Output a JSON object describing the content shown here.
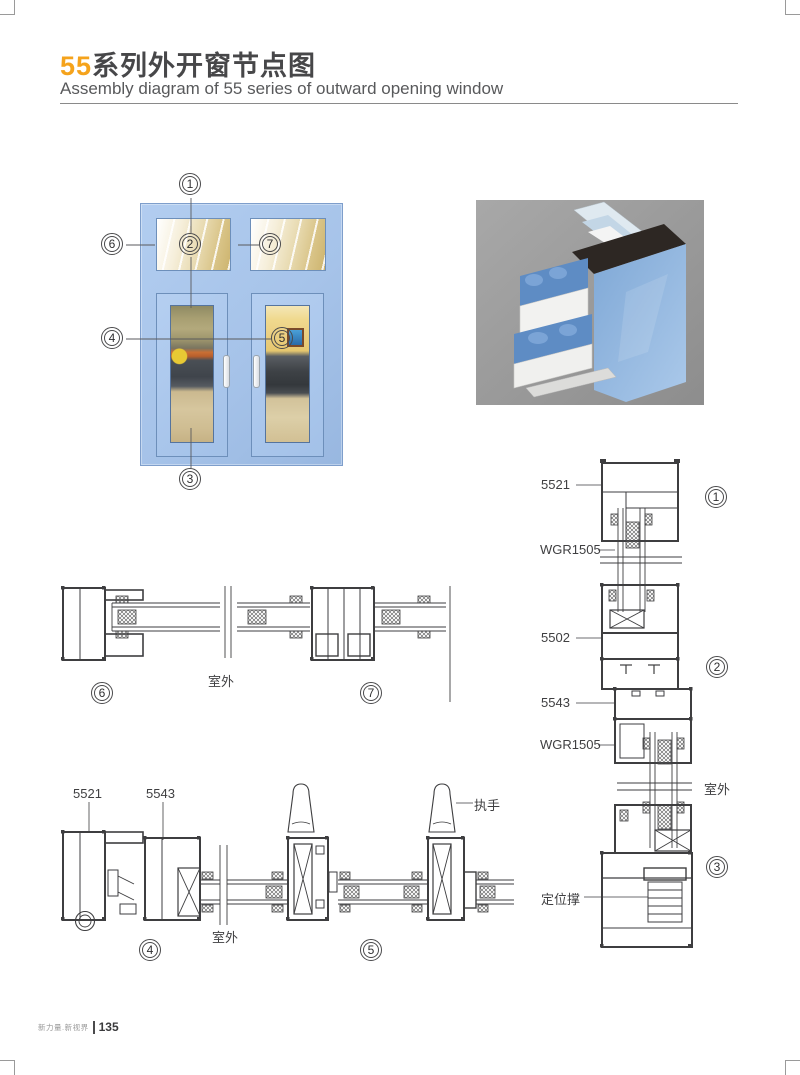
{
  "header": {
    "title_num": "55",
    "title_cn": "系列外开窗节点图",
    "subtitle": "Assembly diagram of 55 series of outward opening window"
  },
  "window_diagram": {
    "callouts": {
      "c1": "1",
      "c2": "2",
      "c3": "3",
      "c4": "4",
      "c5": "5",
      "c6": "6",
      "c7": "7"
    }
  },
  "section_67": {
    "circle_left": "6",
    "circle_right": "7",
    "outdoor": "室外"
  },
  "section_45": {
    "circle_left": "4",
    "circle_right": "5",
    "outdoor": "室外",
    "label_5521": "5521",
    "label_5543": "5543",
    "label_handle": "执手"
  },
  "section_123": {
    "circle_1": "1",
    "circle_2": "2",
    "circle_3": "3",
    "outdoor": "室外",
    "label_5521": "5521",
    "label_wgr_top": "WGR1505",
    "label_5502": "5502",
    "label_5543": "5543",
    "label_wgr_bottom": "WGR1505",
    "label_stay": "定位撑"
  },
  "footer": {
    "slogan": "新力量.新视界",
    "page_number": "135"
  },
  "colors": {
    "accent_orange": "#F5A31C",
    "frame_blue": "#A6C3E9",
    "line_gray": "#3F3F41",
    "render_bg": "#9A9A9A"
  }
}
